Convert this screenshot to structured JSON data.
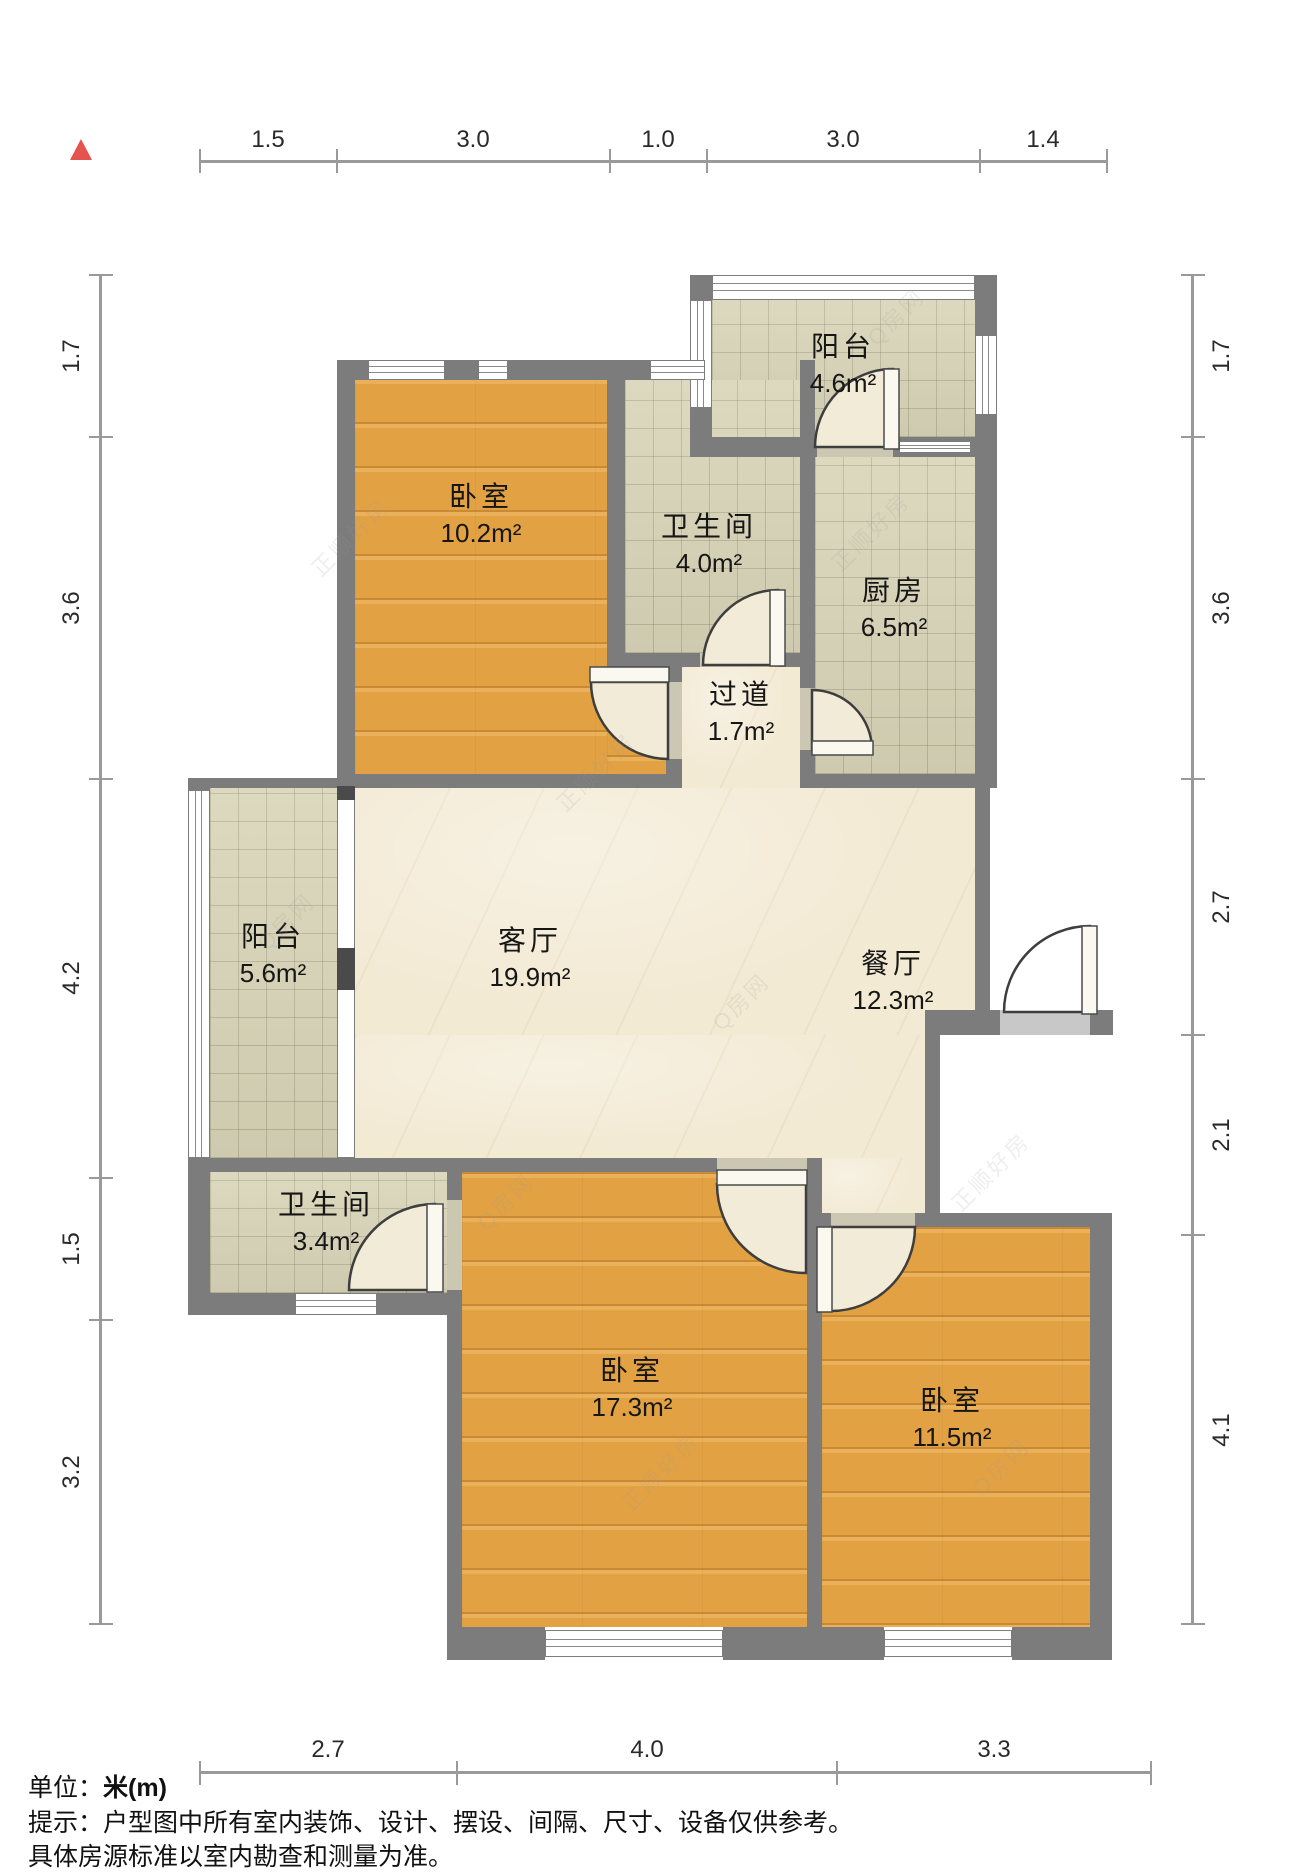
{
  "rooms": [
    {
      "name": "阳台",
      "area": "4.6m²"
    },
    {
      "name": "卧室",
      "area": "10.2m²"
    },
    {
      "name": "卫生间",
      "area": "4.0m²"
    },
    {
      "name": "厨房",
      "area": "6.5m²"
    },
    {
      "name": "过道",
      "area": "1.7m²"
    },
    {
      "name": "客厅",
      "area": "19.9m²"
    },
    {
      "name": "餐厅",
      "area": "12.3m²"
    },
    {
      "name": "阳台",
      "area": "5.6m²"
    },
    {
      "name": "卫生间",
      "area": "3.4m²"
    },
    {
      "name": "卧室",
      "area": "17.3m²"
    },
    {
      "name": "卧室",
      "area": "11.5m²"
    }
  ],
  "dimensions": {
    "top": [
      "1.5",
      "3.0",
      "1.0",
      "3.0",
      "1.4"
    ],
    "left": [
      "1.7",
      "3.6",
      "4.2",
      "1.5",
      "3.2"
    ],
    "right": [
      "1.7",
      "3.6",
      "2.7",
      "2.1",
      "4.1"
    ],
    "bottom": [
      "2.7",
      "4.0",
      "3.3"
    ]
  },
  "footer": {
    "unit_prefix": "单位：",
    "unit_value": "米(m)",
    "tip_line1": "提示：户型图中所有室内装饰、设计、摆设、间隔、尺寸、设备仅供参考。",
    "tip_line2": "具体房源标准以室内勘查和测量为准。"
  },
  "watermarks": {
    "brand_a": "正顺好房",
    "brand_b": "Q房网"
  }
}
